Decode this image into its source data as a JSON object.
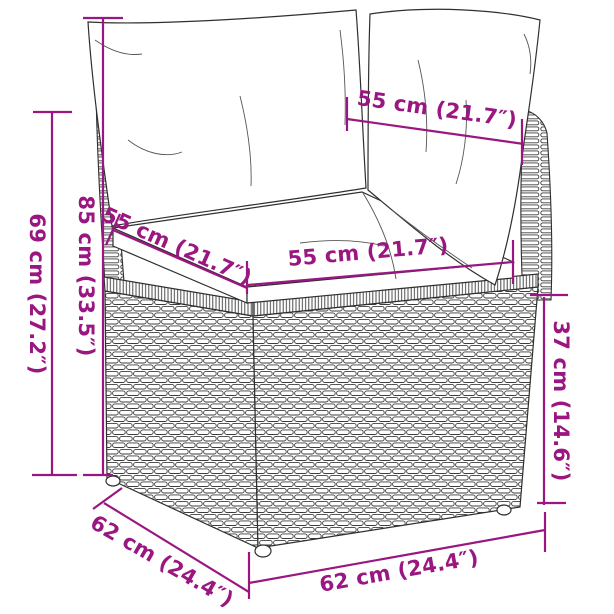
{
  "diagram": {
    "kind": "product-dimension-diagram",
    "subject": "poly rattan corner sofa section with back and seat cushions",
    "background_color": "#ffffff",
    "accent_color": "#9A1680",
    "line_art_color": "#2f2f2f",
    "dimensions": [
      {
        "id": "arm-height",
        "label": "69 cm (27.2″)",
        "value_cm": 69,
        "value_in": 27.2,
        "orientation": "vertical-left-outer"
      },
      {
        "id": "total-height",
        "label": "85 cm (33.5″)",
        "value_cm": 85,
        "value_in": 33.5,
        "orientation": "vertical-left-inner"
      },
      {
        "id": "back-cushion-width",
        "label": "55 cm (21.7″)",
        "value_cm": 55,
        "value_in": 21.7,
        "orientation": "diagonal-top"
      },
      {
        "id": "seat-depth",
        "label": "55 cm (21.7″)",
        "value_cm": 55,
        "value_in": 21.7,
        "orientation": "diagonal-left"
      },
      {
        "id": "seat-width",
        "label": "55 cm (21.7″)",
        "value_cm": 55,
        "value_in": 21.7,
        "orientation": "horizontal-middle"
      },
      {
        "id": "base-height",
        "label": "37 cm (14.6″)",
        "value_cm": 37,
        "value_in": 14.6,
        "orientation": "vertical-right"
      },
      {
        "id": "base-depth",
        "label": "62 cm (24.4″)",
        "value_cm": 62,
        "value_in": 24.4,
        "orientation": "diagonal-bottom-left"
      },
      {
        "id": "base-width",
        "label": "62 cm (24.4″)",
        "value_cm": 62,
        "value_in": 24.4,
        "orientation": "horizontal-bottom"
      }
    ]
  }
}
